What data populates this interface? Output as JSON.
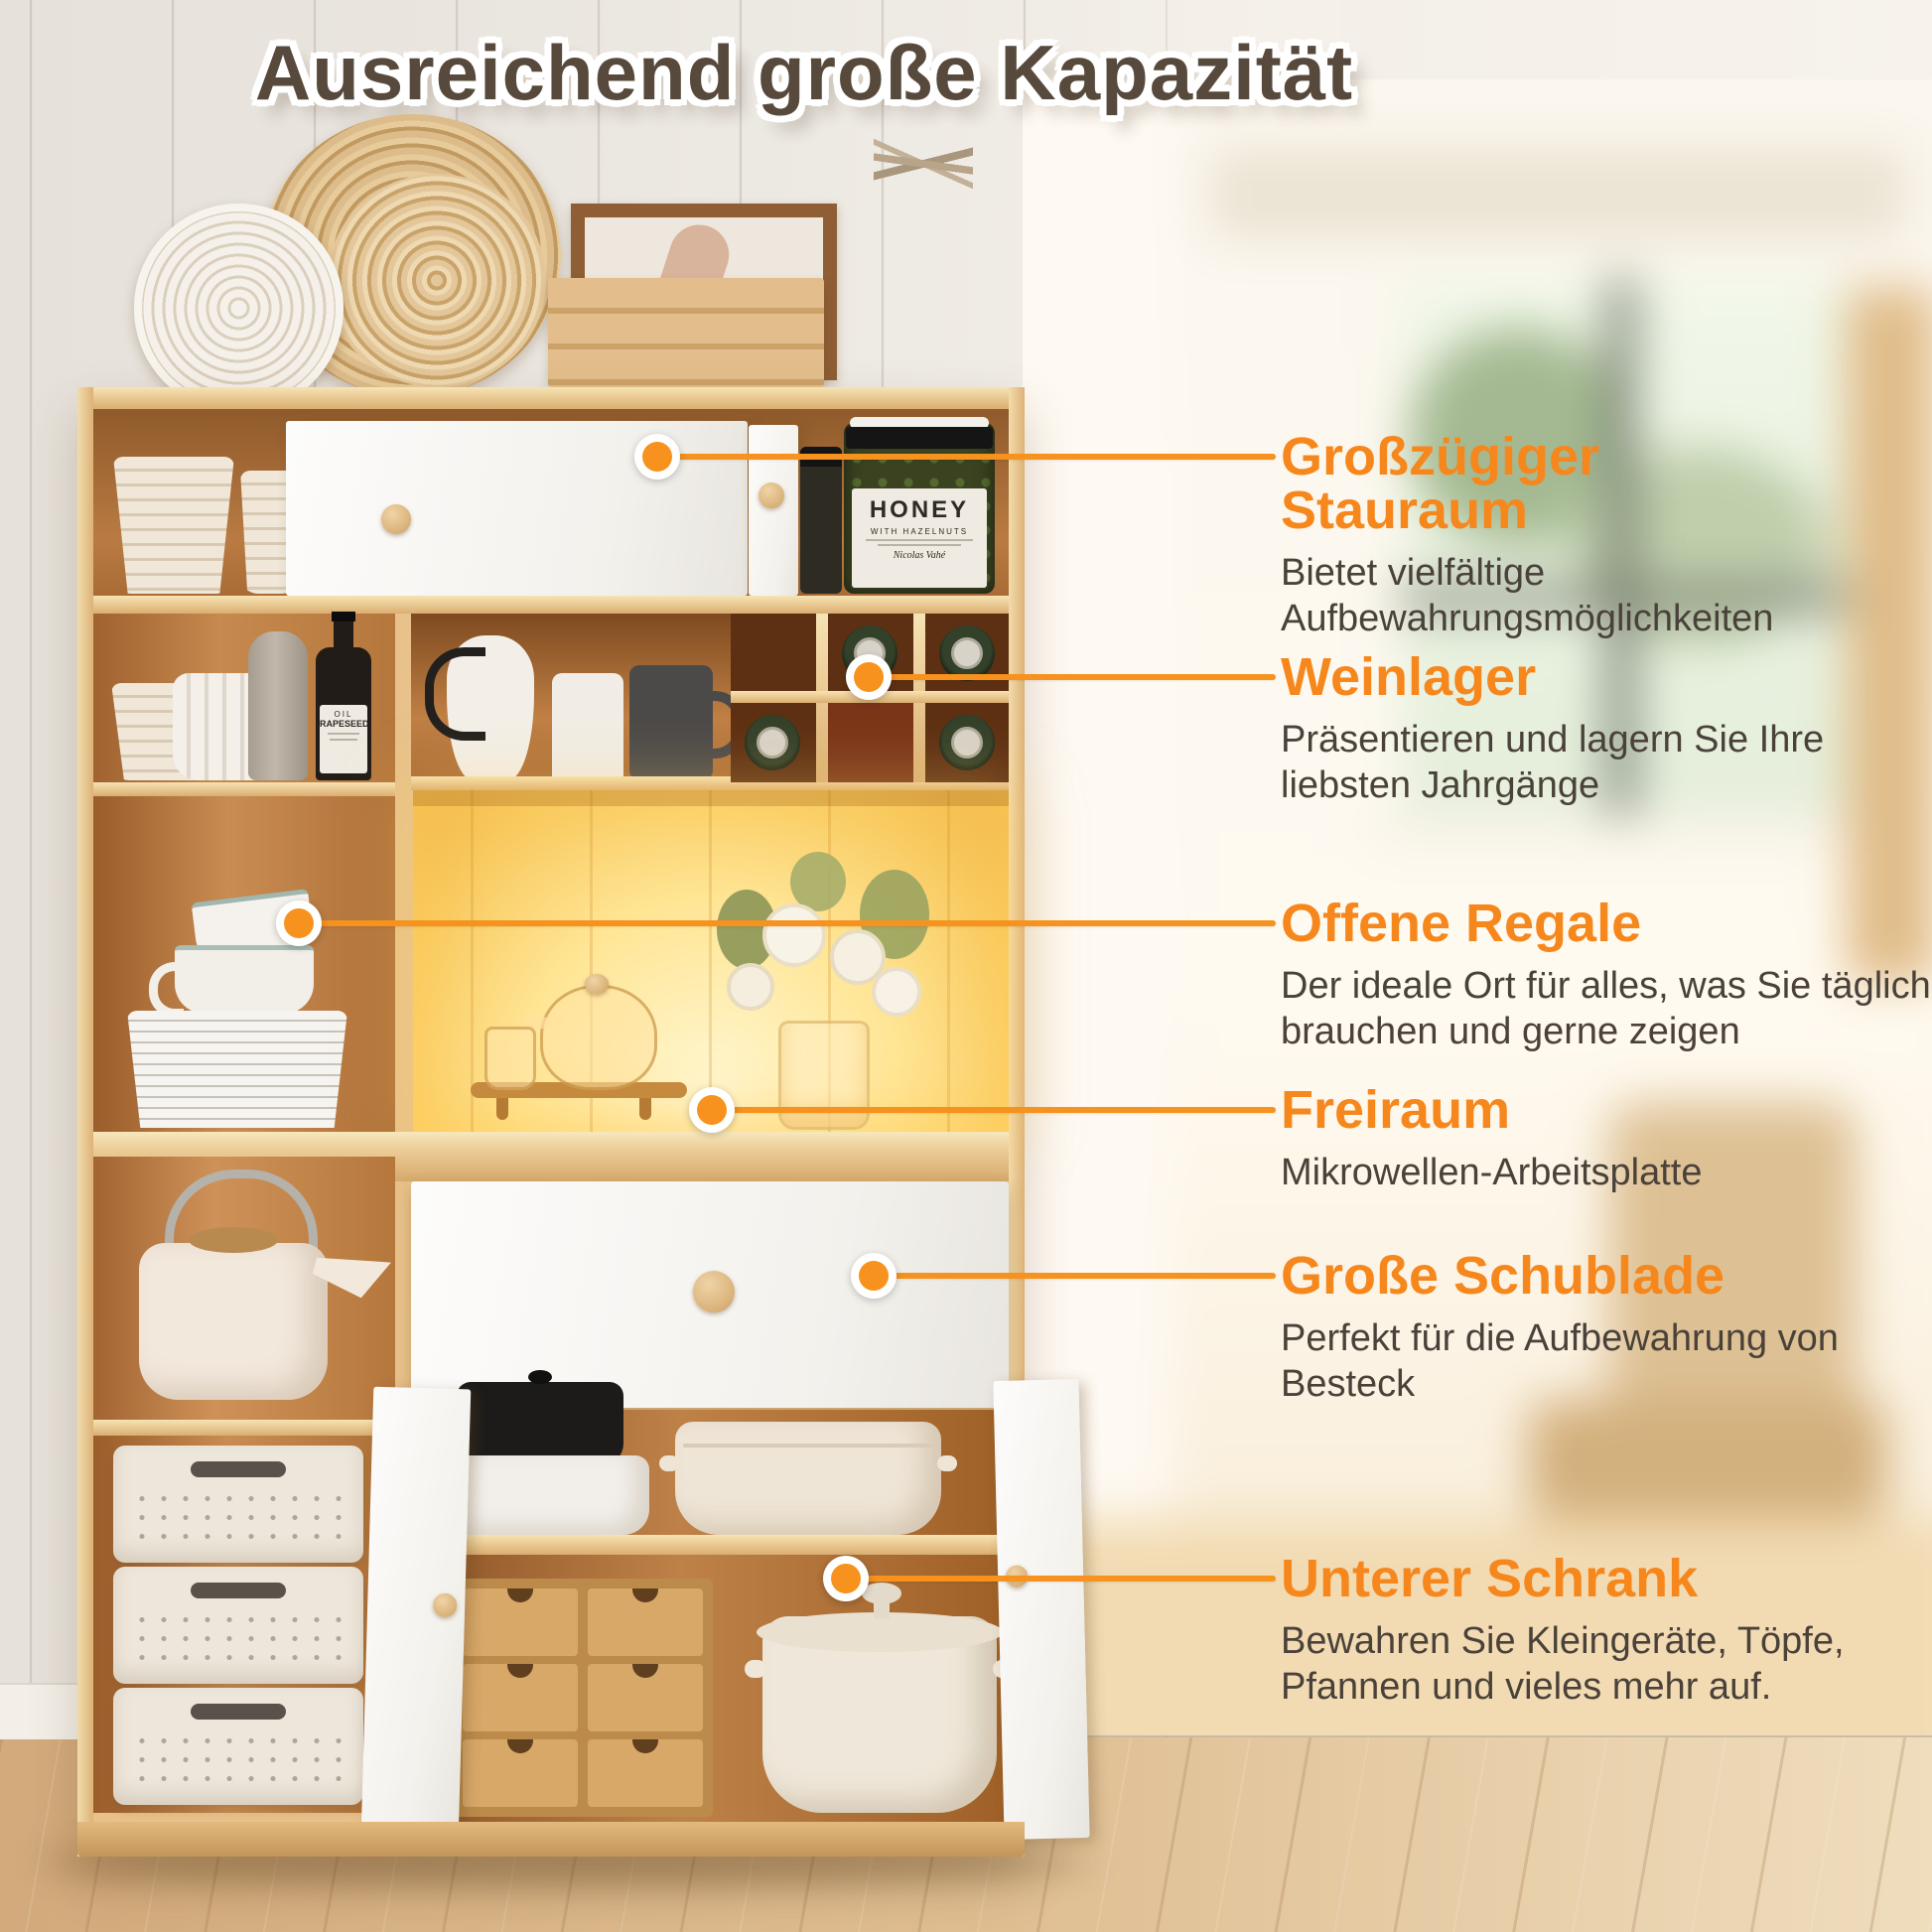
{
  "headline": "Ausreichend große Kapazität",
  "colors": {
    "accent": "#F6871D",
    "headline": "#57493B",
    "body_text": "#4A423A"
  },
  "callouts": [
    {
      "title": "Großzügiger Stauraum",
      "body": "Bietet vielfältige Aufbewahrungsmöglichkeiten"
    },
    {
      "title": "Weinlager",
      "body": "Präsentieren und lagern Sie Ihre liebsten Jahrgänge"
    },
    {
      "title": "Offene Regale",
      "body": "Der ideale Ort für alles, was Sie täglich brauchen und gerne zeigen"
    },
    {
      "title": "Freiraum",
      "body": "Mikrowellen-Arbeitsplatte"
    },
    {
      "title": "Große Schublade",
      "body": "Perfekt für die Aufbewahrung von Besteck"
    },
    {
      "title": "Unterer Schrank",
      "body": "Bewahren Sie Kleingeräte, Töpfe, Pfannen und vieles mehr auf."
    }
  ],
  "photo_labels": {
    "honey_jar": {
      "line1": "HONEY",
      "line2": "WITH HAZELNUTS",
      "brand": "Nicolas Vahé"
    },
    "oil_bottle": {
      "line1": "OIL",
      "line2": "RAPESEED"
    }
  }
}
